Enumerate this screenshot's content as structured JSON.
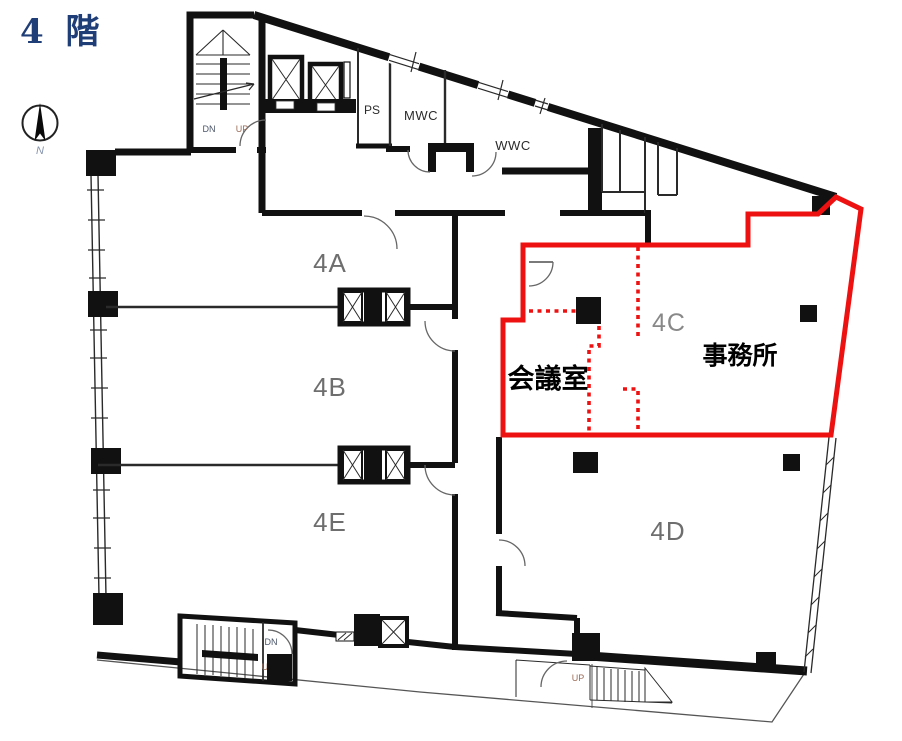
{
  "title": "4 階",
  "compass": {
    "north": "N"
  },
  "units": {
    "a": {
      "label": "4A"
    },
    "b": {
      "label": "4B"
    },
    "e": {
      "label": "4E"
    },
    "c": {
      "label": "4C"
    },
    "d": {
      "label": "4D"
    }
  },
  "highlight": {
    "office": "事務所",
    "meeting_room": "会議室",
    "color": "#ee1111"
  },
  "facilities": {
    "mwc": "MWC",
    "wwc": "WWC",
    "ps": "PS"
  },
  "stairs": {
    "top": {
      "dn": "DN",
      "up": "UP"
    },
    "bottom": {
      "dn": "DN",
      "up": "UP"
    },
    "exterior": {
      "up": "UP"
    }
  },
  "colors": {
    "wall": "#111111",
    "highlight": "#ee1111",
    "title": "#1f3e78",
    "room_label": "#6e6e6e"
  }
}
